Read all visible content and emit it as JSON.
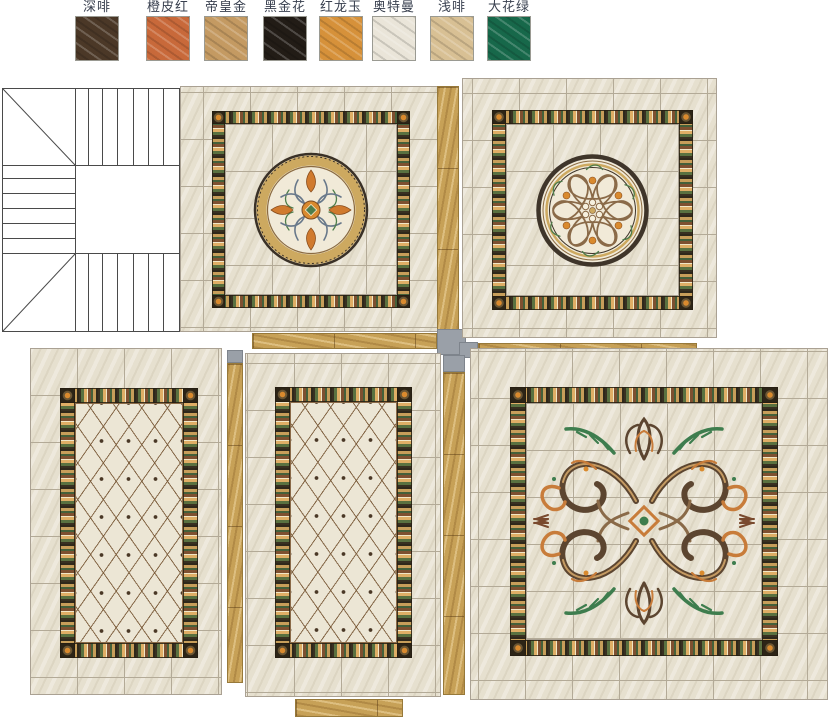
{
  "legend": {
    "items": [
      {
        "label": "深啡",
        "color": "#4b3827"
      },
      {
        "label": "橙皮红",
        "color": "#c8693a"
      },
      {
        "label": "帝皇金",
        "color": "#c49a62"
      },
      {
        "label": "黑金花",
        "color": "#221c16"
      },
      {
        "label": "红龙玉",
        "color": "#d6913a"
      },
      {
        "label": "奥特曼",
        "color": "#eae5d9"
      },
      {
        "label": "浅啡",
        "color": "#d8c094"
      },
      {
        "label": "大花绿",
        "color": "#17684a"
      }
    ]
  },
  "palette": {
    "tile_beige": "#e6e0cf",
    "grout": "#b3aa97",
    "threshold_gold": "#c7a157",
    "wall_gray": "#9aa0a8",
    "border_dark": "#383021",
    "border_green": "#44603a",
    "border_orange": "#dfae66",
    "accent_orange": "#d98a2e",
    "accent_green": "#3e7d4e",
    "scroll_brown": "#5c4530",
    "stair_line": "#4a4a4a"
  },
  "panels": [
    {
      "id": "staircase-plan",
      "type": "staircase"
    },
    {
      "id": "top-center",
      "type": "circular-medallion"
    },
    {
      "id": "top-right",
      "type": "circular-rosette-medallion"
    },
    {
      "id": "bottom-left",
      "type": "diamond-lattice"
    },
    {
      "id": "bottom-center",
      "type": "diamond-lattice"
    },
    {
      "id": "bottom-right",
      "type": "scroll-medallion"
    }
  ]
}
